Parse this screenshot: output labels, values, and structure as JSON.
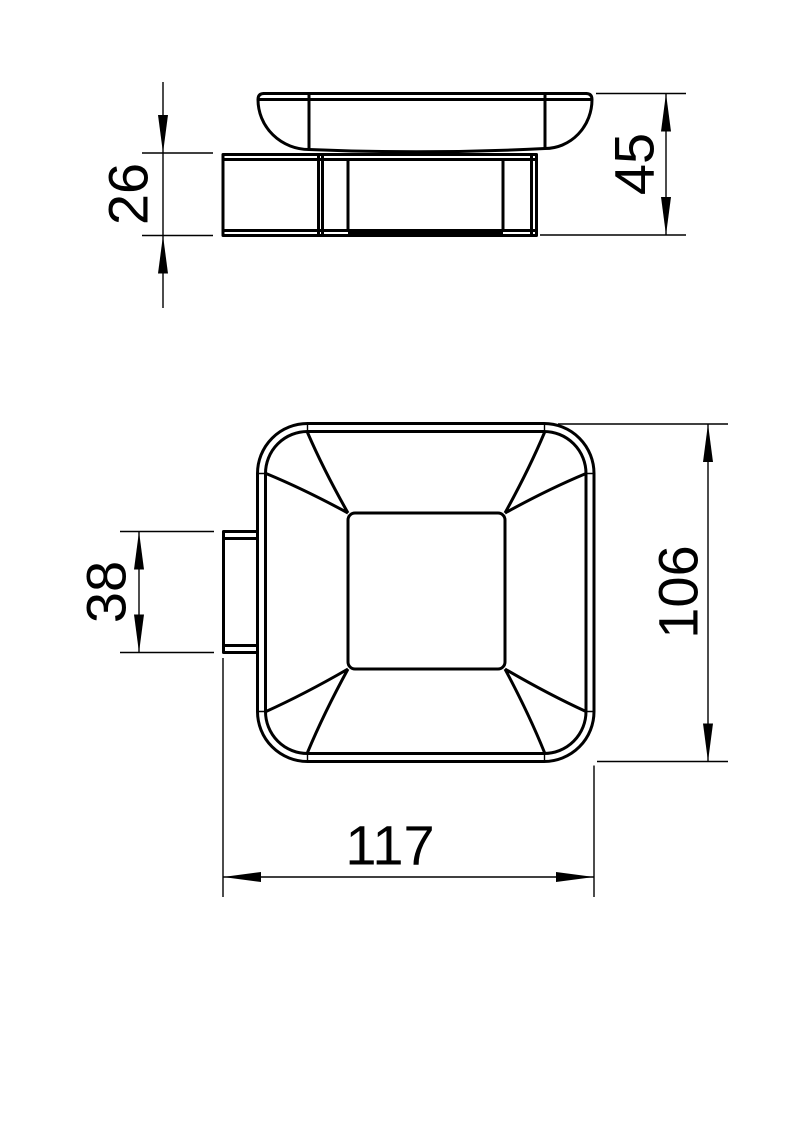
{
  "page": {
    "background_color": "#ffffff",
    "line_color": "#000000"
  },
  "drawing": {
    "dimensions": {
      "side_mount_height": "26",
      "side_overall_height": "45",
      "plan_tab_length": "38",
      "plan_body_depth": "106",
      "plan_overall_width": "117"
    }
  }
}
